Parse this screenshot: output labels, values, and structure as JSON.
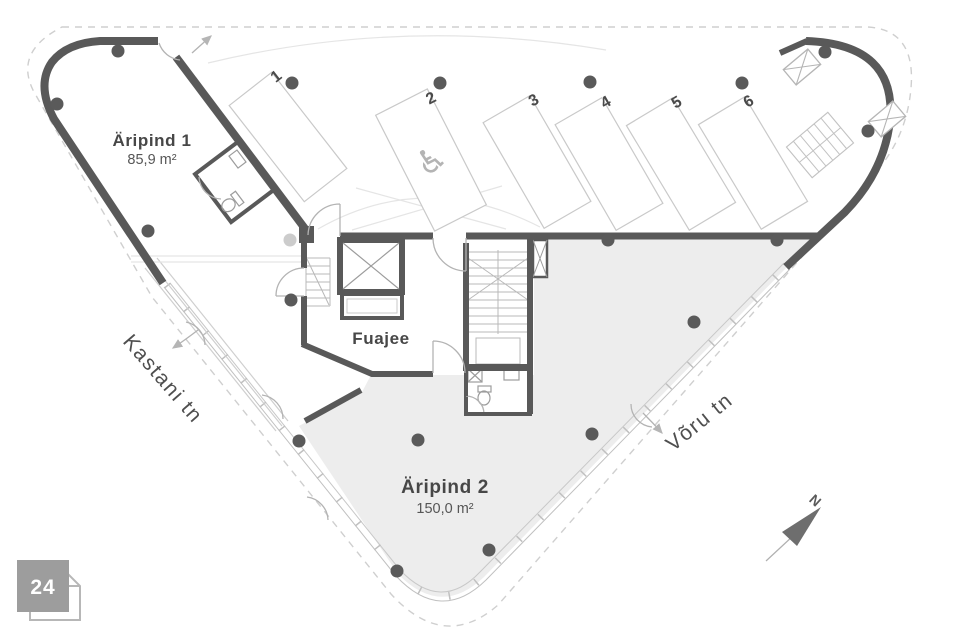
{
  "sheet": {
    "number": "24"
  },
  "rooms": [
    {
      "name": "Äripind 1",
      "area": "85,9 m²"
    },
    {
      "name": "Äripind 2",
      "area": "150,0 m²"
    },
    {
      "name": "Fuajee",
      "area": ""
    }
  ],
  "parking": {
    "spaces": [
      {
        "label": "1"
      },
      {
        "label": "2"
      },
      {
        "label": "3"
      },
      {
        "label": "4"
      },
      {
        "label": "5"
      },
      {
        "label": "6"
      }
    ],
    "accessible_space": "2",
    "accessible_icon": "♿"
  },
  "streets": [
    {
      "name": "Kastani tn"
    },
    {
      "name": "Võru tn"
    }
  ],
  "compass": {
    "north_label": "N"
  },
  "colors": {
    "wall": "#595959",
    "floor_fill": "#ededed",
    "thin_line": "#c4c4c4",
    "text": "#4a4a4a",
    "badge": "#9d9d9d"
  }
}
